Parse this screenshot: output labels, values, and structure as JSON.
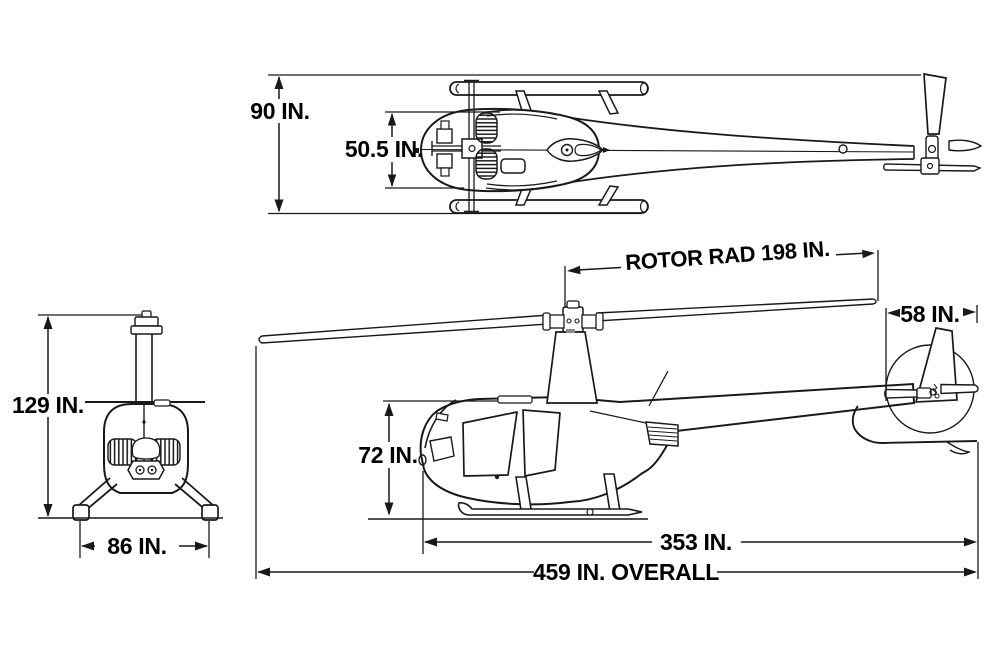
{
  "diagram": {
    "background_color": "#ffffff",
    "line_color": "#191919",
    "text_color": "#000000",
    "top_view": {
      "overall_width_label": "90 IN.",
      "cabin_width_label": "50.5 IN."
    },
    "front_view": {
      "height_label": "129 IN.",
      "skid_track_label": "86 IN."
    },
    "side_view": {
      "rotor_radius_label": "ROTOR RAD 198 IN.",
      "tail_rotor_label": "58 IN.",
      "cabin_height_label": "72 IN.",
      "fuselage_length_label": "353 IN.",
      "overall_length_label": "459 IN. OVERALL"
    }
  }
}
